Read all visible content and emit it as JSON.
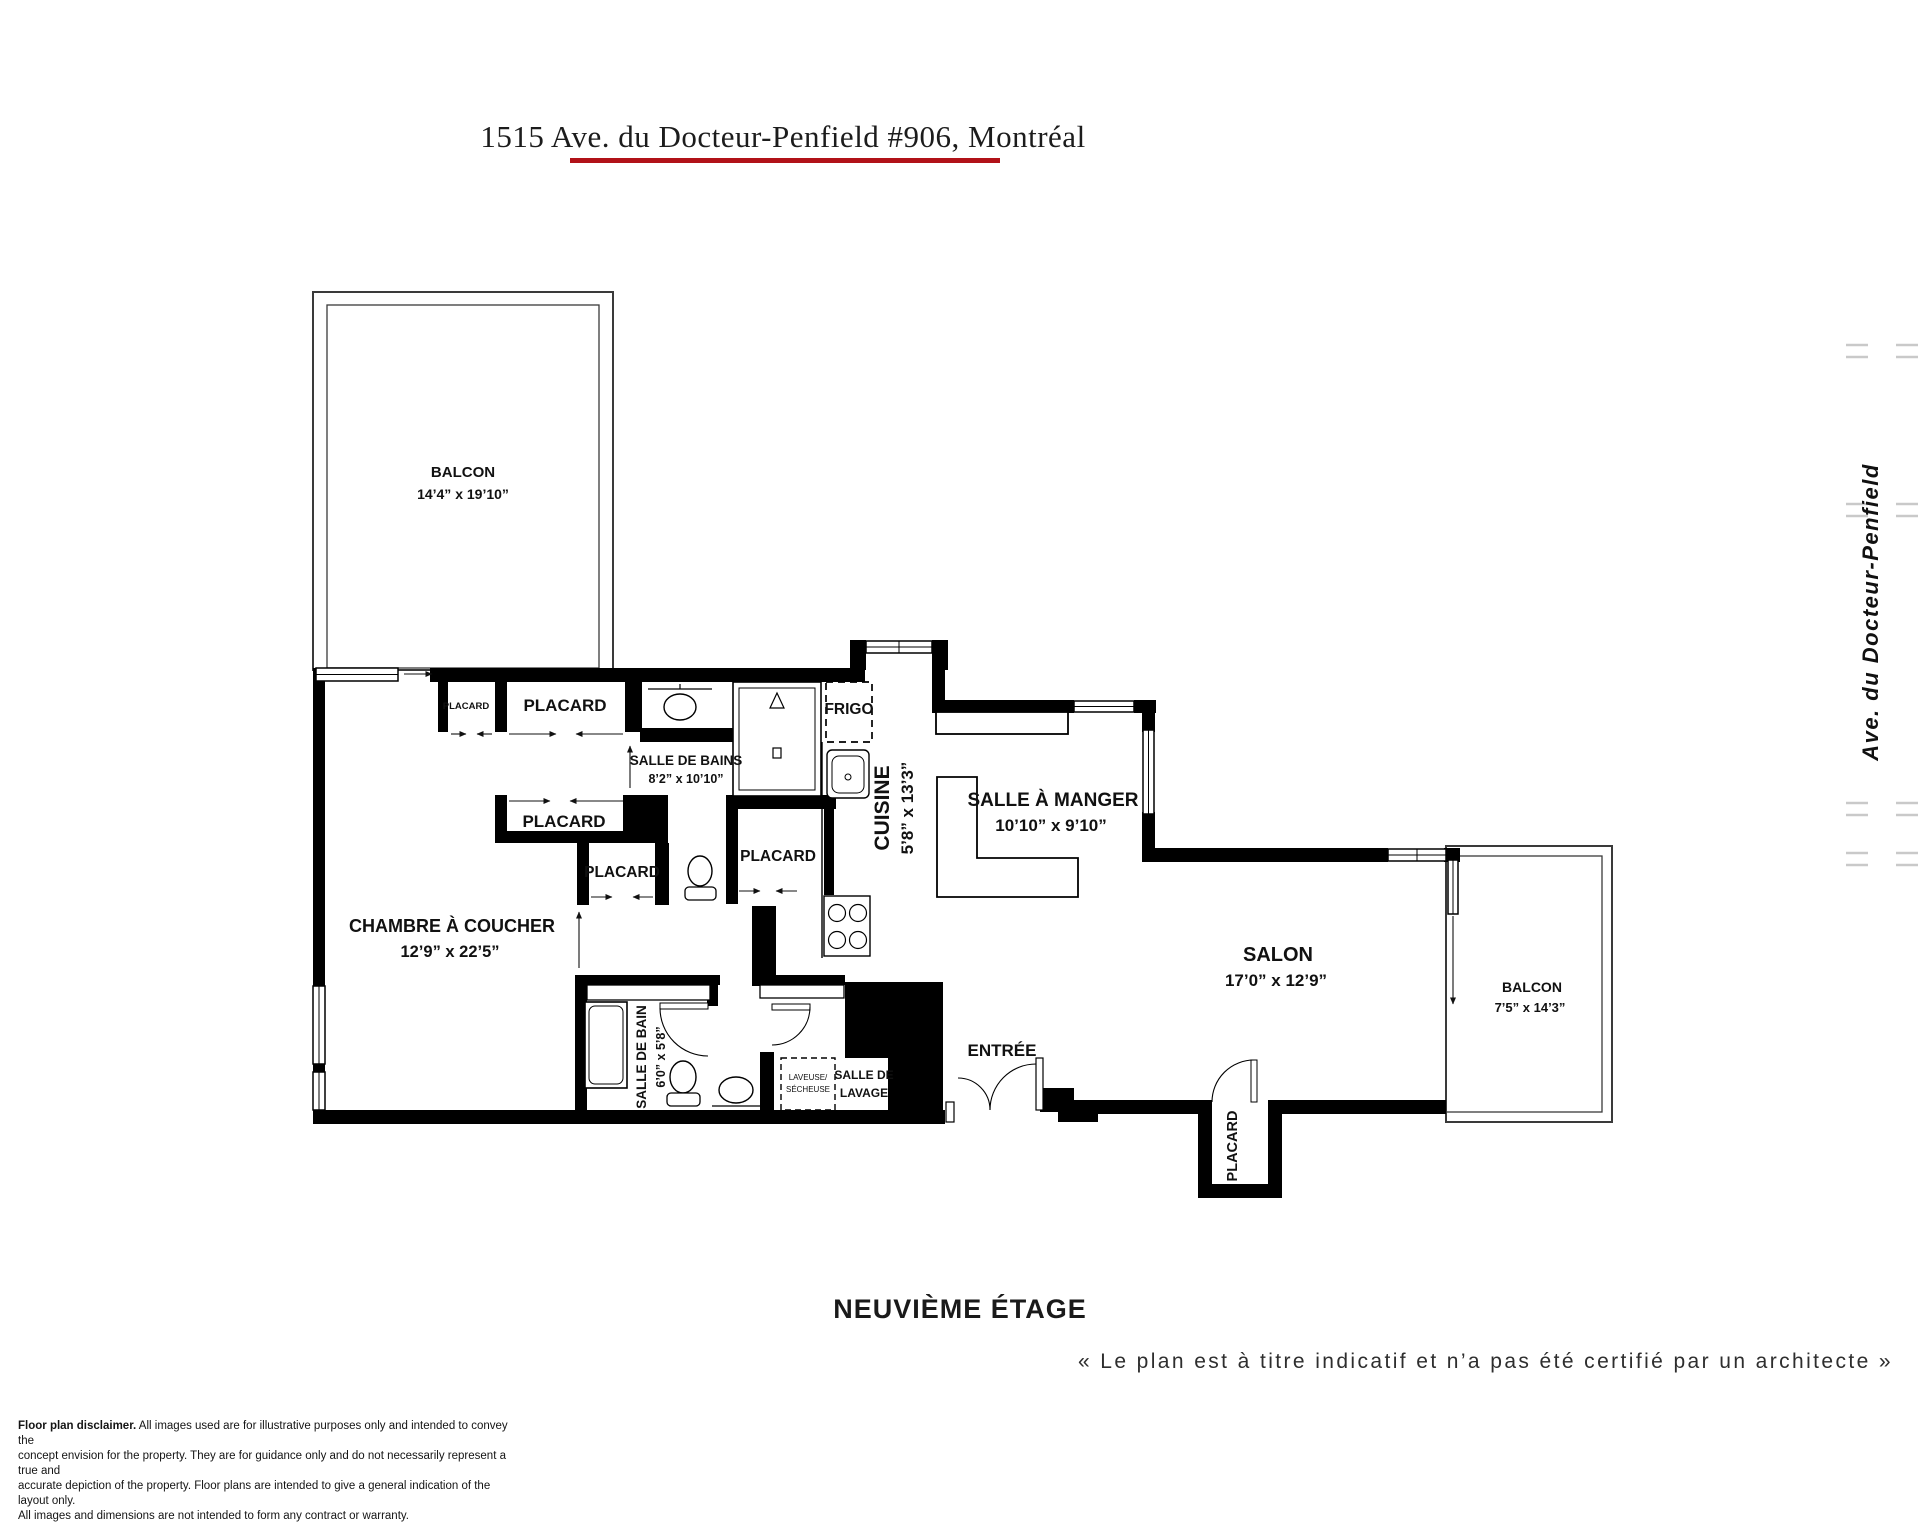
{
  "title": "1515 Ave. du Docteur-Penfield #906, Montréal",
  "plan": {
    "balcon_top": {
      "name": "BALCON",
      "dims": "14’4” x 19’10”"
    },
    "balcon_right": {
      "name": "BALCON",
      "dims": "7’5” x 14’3”"
    },
    "chambre": {
      "name": "CHAMBRE À COUCHER",
      "dims": "12’9” x 22’5”"
    },
    "salle_de_bains": {
      "name": "SALLE DE BAINS",
      "dims": "8’2” x 10’10”"
    },
    "salle_de_bain": {
      "name": "SALLE DE BAIN",
      "dims": "6’0” x 5’8”"
    },
    "cuisine": {
      "name": "CUISINE",
      "dims": "5’8” x 13’3”"
    },
    "salle_a_manger": {
      "name": "SALLE À MANGER",
      "dims": "10’10” x 9’10”"
    },
    "salon": {
      "name": "SALON",
      "dims": "17’0” x 12’9”"
    },
    "entree": {
      "name": "ENTRÉE"
    },
    "frigo": {
      "name": "FRIGO"
    },
    "placard": {
      "name": "PLACARD"
    },
    "laveuse_secheuse": {
      "line1": "LAVEUSE/",
      "line2": "SÉCHEUSE"
    },
    "salle_de_lavage": {
      "line1": "SALLE DE",
      "line2": "LAVAGE"
    }
  },
  "street": {
    "name": "Ave. du Docteur-Penfield"
  },
  "footer": {
    "floor": "NEUVIÈME ÉTAGE",
    "notice": "« Le plan est à titre indicatif et n’a pas été certifié par un architecte »"
  },
  "disclaimer": {
    "lead": "Floor plan disclaimer.",
    "line1_rest": " All images used are for illustrative purposes only and intended to convey the",
    "line2": "concept envision for the property. They are for guidance only and do not necessarily represent a true and",
    "line3": "accurate depiction of the property. Floor plans are intended to give a general indication of the layout only.",
    "line4": "All images and dimensions are not intended to form any contract or warranty."
  },
  "colors": {
    "accent_red": "#b11118",
    "wall": "#000000",
    "street_gray": "#bcbcbc"
  }
}
